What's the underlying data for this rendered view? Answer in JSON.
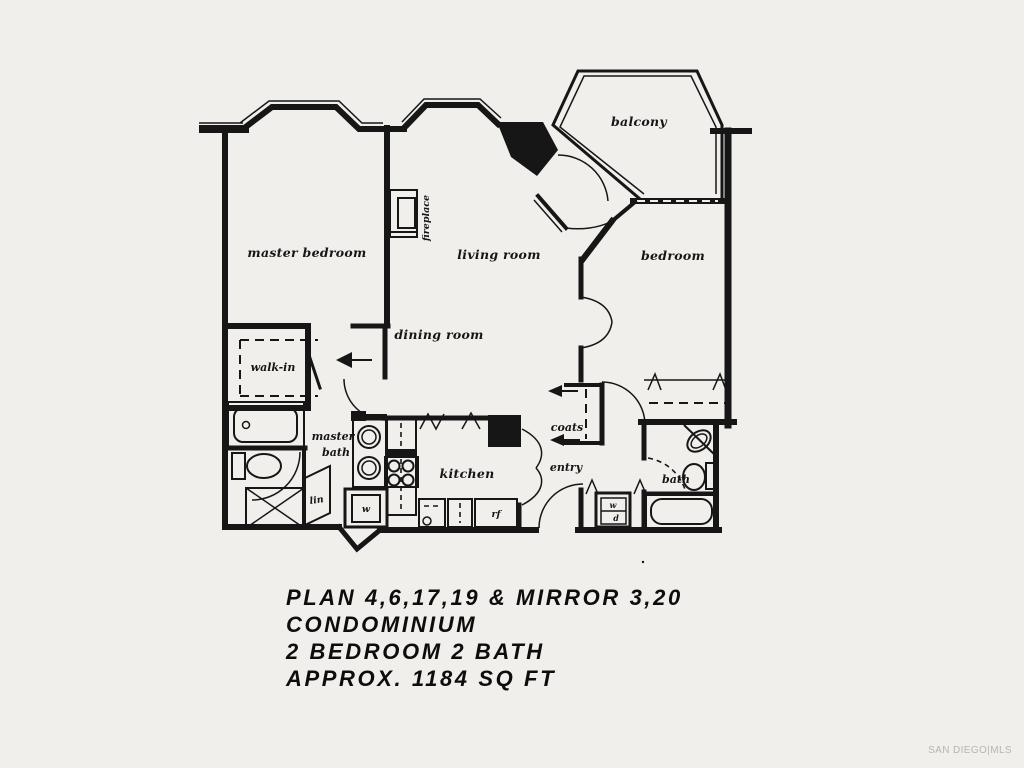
{
  "colors": {
    "paper": "#f1efec",
    "ink": "#161616",
    "caption-ink": "#0d0d0d",
    "watermark-ink": "#b7b5b2"
  },
  "floor_plan": {
    "rooms": {
      "master_bedroom": "master bedroom",
      "living_room": "living room",
      "dining_room": "dining room",
      "bedroom": "bedroom",
      "balcony": "balcony",
      "kitchen": "kitchen",
      "walk_in": "walk-in",
      "master_bath_line1": "master",
      "master_bath_line2": "bath",
      "bath": "bath",
      "entry": "entry",
      "coats": "coats",
      "linen": "lin",
      "fireplace": "fireplace"
    },
    "fixtures": {
      "washer": "w",
      "stacked_washer": "w",
      "stacked_dryer": "d",
      "refrigerator": "rf"
    }
  },
  "caption": {
    "lines": [
      "PLAN 4,6,17,19 & MIRROR 3,20",
      "CONDOMINIUM",
      "2 BEDROOM 2 BATH",
      "APPROX. 1184 SQ FT"
    ]
  },
  "watermark": {
    "text": "SAN DIEGO|MLS"
  }
}
